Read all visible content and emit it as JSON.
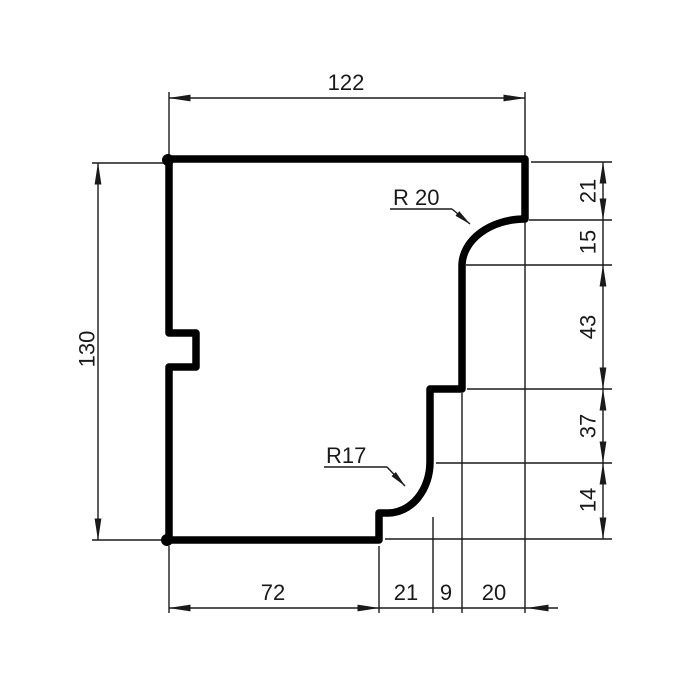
{
  "drawing": {
    "type": "technical-profile-section",
    "dimensions": {
      "top_width": "122",
      "left_height": "130",
      "right_stack": [
        "21",
        "15",
        "43",
        "37",
        "14"
      ],
      "bottom_row": [
        "72",
        "21",
        "9",
        "20"
      ],
      "radius_upper": "R 20",
      "radius_lower": "R17"
    },
    "colors": {
      "outline": "#000000",
      "dimension_lines": "#1a1a1a",
      "background": "#ffffff"
    }
  }
}
